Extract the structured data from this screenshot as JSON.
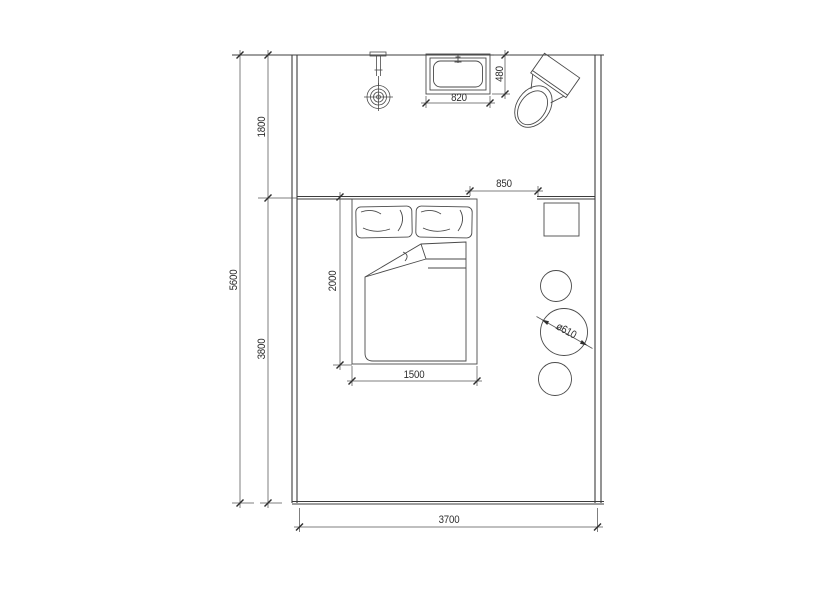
{
  "title": "bedroom-floor-plan",
  "colors": {
    "wall_line": "#3c3c3c",
    "object_line": "#4a4a4a",
    "dimension_line": "#555555",
    "text": "#2e2e2e",
    "background": "#ffffff"
  },
  "dimensions": {
    "room_total_depth": "5600",
    "bath_zone_depth": "1800",
    "bedroom_zone_depth": "3800",
    "vanity_width": "820",
    "vanity_depth": "480",
    "door_opening": "850",
    "bed_length": "2000",
    "bed_width": "1500",
    "room_width": "3700",
    "table_diameter": "ø610"
  },
  "objects": {
    "vanity": "vanity-sink",
    "toilet": "toilet",
    "wall_light": "wall-light-fixture",
    "bed": "double-bed",
    "nightstand": "nightstand",
    "table": "round-table",
    "stools": "round-stools"
  }
}
